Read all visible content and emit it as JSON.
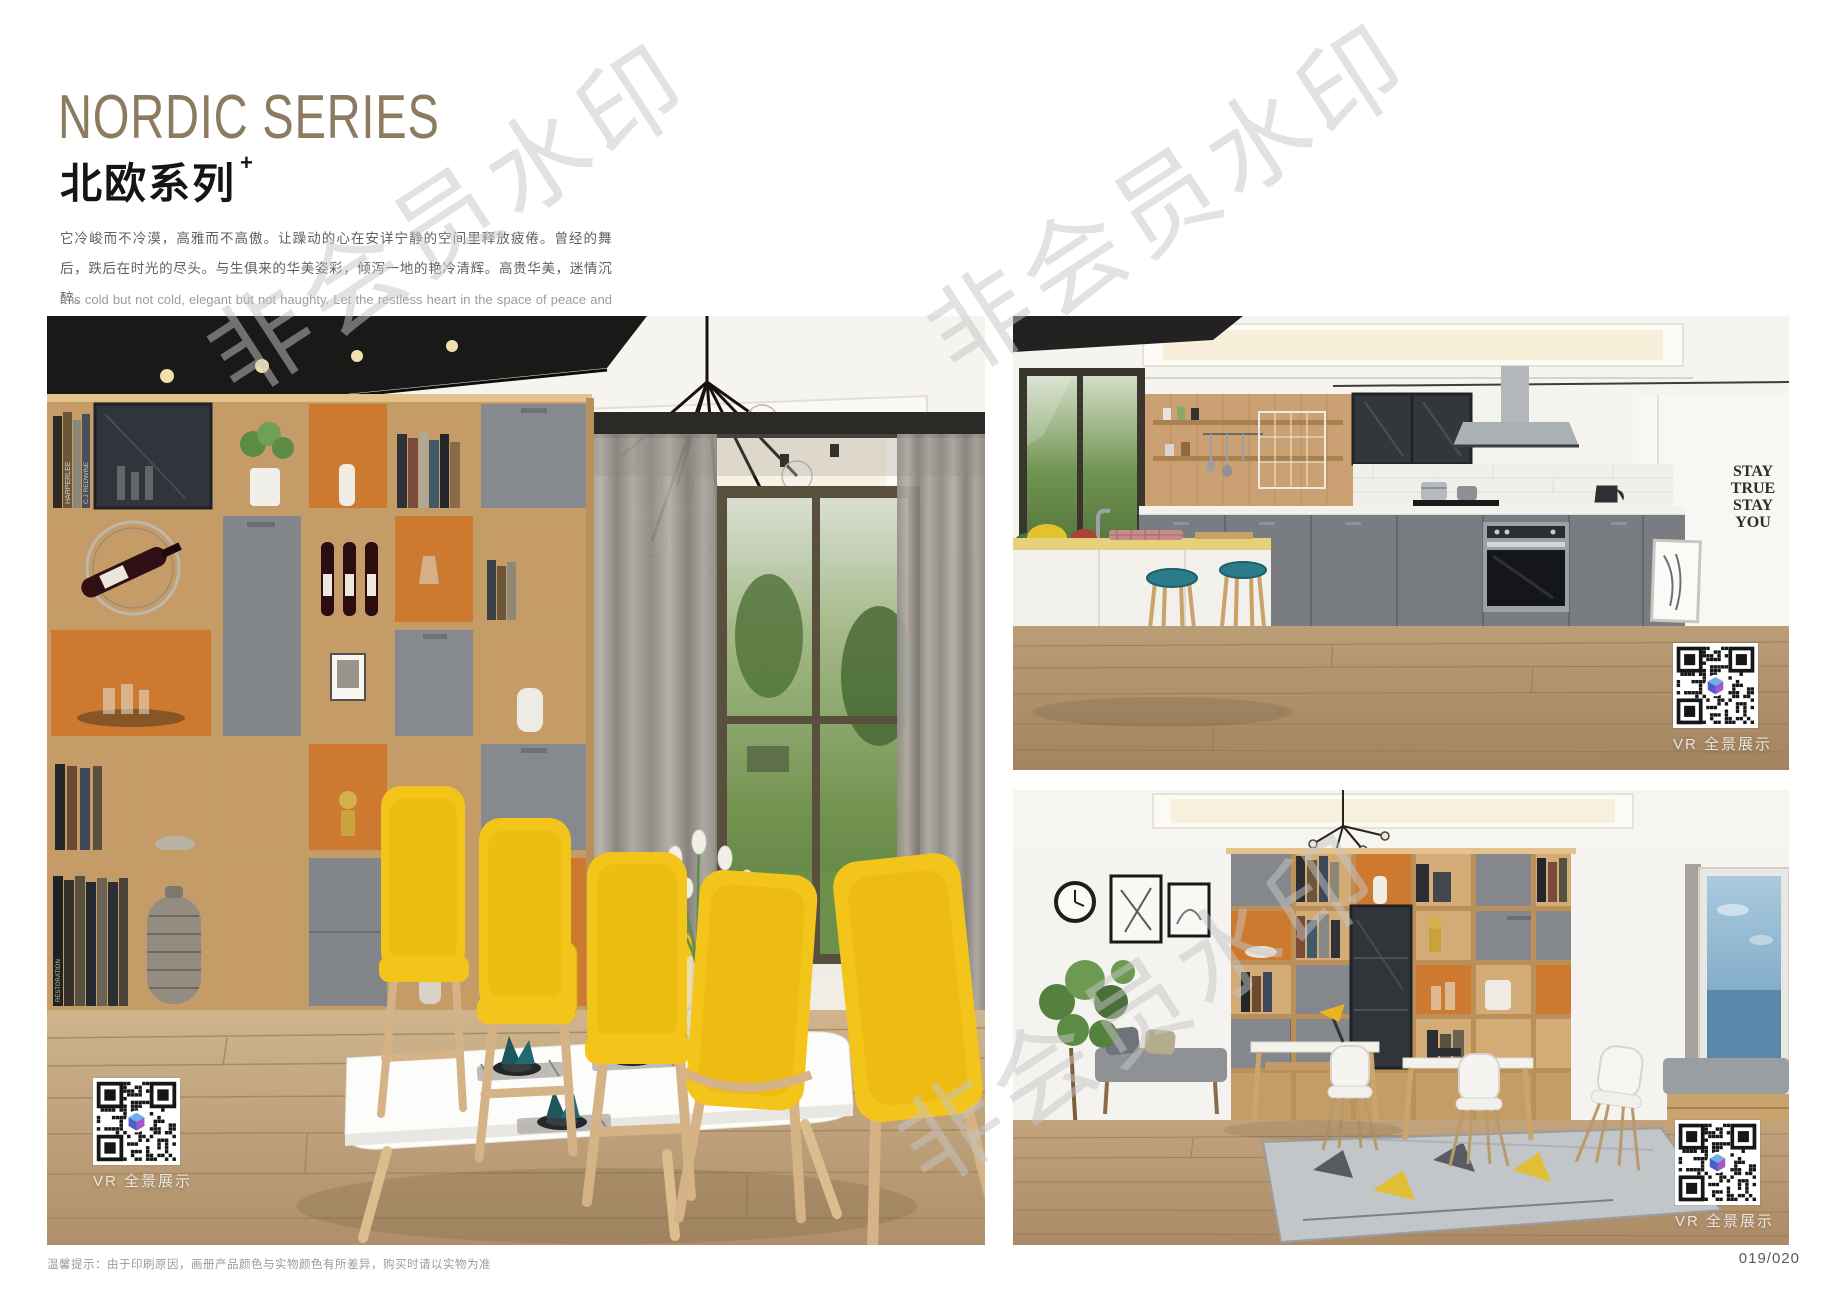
{
  "header": {
    "title_en": "NORDIC SERIES",
    "title_zh": "北欧系列",
    "title_superscript": "+",
    "intro_zh": "它冷峻而不冷漠，高雅而不高傲。让躁动的心在安详宁静的空间里释放疲倦。曾经的舞后，跌后在时光的尽头。与生俱来的华美姿彩，倾泻一地的艳冷清辉。高贵华美，迷情沉醉。",
    "intro_en": "It is cold but not cold, elegant but not haughty. Let the restless heart in the space of peace and tranquility release fatigue. Once the Queen of Dance, fall in the end of time. The natural beauty of the beautiful, pouring a land of cold and pure brilliance. Noble, beautiful, enchanted."
  },
  "photos": {
    "dining": {
      "description": "Nordic dining room with oak display shelving, wine bottles, white table and yellow chairs",
      "vr_label": "VR 全景展示",
      "book_spines": [
        "HARPERLEE",
        "C.J REDWINE",
        "RESTORATION"
      ]
    },
    "kitchen": {
      "description": "Open kitchen with island bar, teal stools, grey cabinets and stainless hood",
      "vr_label": "VR 全景展示",
      "wall_text": {
        "line1": "STAY",
        "line2": "TRUE",
        "line3": "STAY",
        "line4": "YOU"
      }
    },
    "study": {
      "description": "Home study with shelving wall, twin desks, white chairs and sea-view window",
      "vr_label": "VR 全景展示"
    }
  },
  "watermark": {
    "text": "非会员水印"
  },
  "footer": {
    "note": "温馨提示：由于印刷原因，画册产品颜色与实物颜色有所差异，购买时请以实物为准",
    "page_number": "019/020"
  },
  "colors": {
    "title_taupe": "#8c7b61",
    "accent_orange": "#cd7930",
    "chair_yellow": "#f3c51b",
    "stool_teal": "#2a7c8b",
    "wood_oak": "#c59c68",
    "cabinet_grey": "#868a8e"
  }
}
